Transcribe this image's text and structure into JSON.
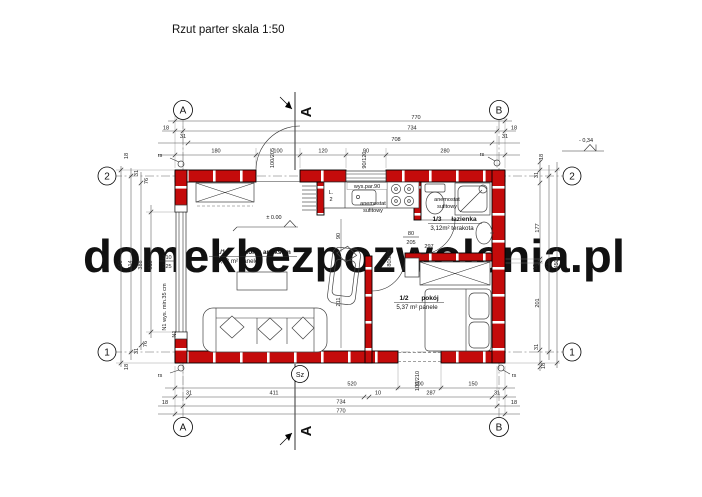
{
  "title": "Rzut parter skala 1:50",
  "watermark": "domekbezpozwolenia.pl",
  "grid": {
    "col_a": "A",
    "col_b": "B",
    "row_1": "1",
    "row_2": "2"
  },
  "section_mark": "A",
  "levels": {
    "ground": "± 0.00",
    "entry": "- 0,34"
  },
  "markers": {
    "chimney": "Sz",
    "roof_drain": "rs",
    "window_left": "N1",
    "foundation_note": "N1 wys. min.35 cm",
    "fridge": "L.",
    "fridge_no": "2"
  },
  "rooms": {
    "salon": {
      "no": "1/1",
      "name": "salon z aneksem",
      "finish": "18,33 m² panele"
    },
    "pokoj": {
      "no": "1/2",
      "name": "pokój",
      "finish": "5,37 m² panele"
    },
    "lazienka": {
      "no": "1/3",
      "name": "łazienka",
      "finish": "3,12m² terakota"
    }
  },
  "notes": {
    "partition": "wys.par.90",
    "vent_line1": "anemostat",
    "vent_line2": "sufitowy"
  },
  "openings": {
    "entrance": "100/205",
    "kitchen_window": "90/120",
    "salon_window_top": "310",
    "salon_window_bottom": "225",
    "bathroom_door_top": "80",
    "bathroom_door_bottom": "205",
    "pokoj_door": "80/205",
    "back_door": "100/210"
  },
  "dims": {
    "top": {
      "r1": "770",
      "r2": "734",
      "r2_side_l": "18",
      "r2_side_r": "18",
      "r3": "708",
      "r3_off_l": "31",
      "r3_off_r": "31",
      "seg": [
        "180",
        "100",
        "120",
        "90",
        "280"
      ]
    },
    "bottom": {
      "r1": [
        "520",
        "100",
        "150"
      ],
      "r2": [
        "31",
        "411",
        "10",
        "287",
        "31"
      ],
      "r3": "734",
      "r3_side_l": "18",
      "r3_side_r": "18",
      "r4": "770"
    },
    "left": {
      "c1": "450",
      "c2": "414",
      "c3": "388",
      "c4": "310",
      "top": [
        "18",
        "31",
        "76"
      ],
      "bot": [
        "76",
        "31",
        "18"
      ]
    },
    "right": {
      "col": [
        "18",
        "31",
        "177",
        "10",
        "201",
        "31",
        "18"
      ],
      "c2": "414",
      "c3": "450"
    },
    "inner": {
      "passage": "90",
      "hall": "211",
      "bath_diag": "297"
    }
  }
}
